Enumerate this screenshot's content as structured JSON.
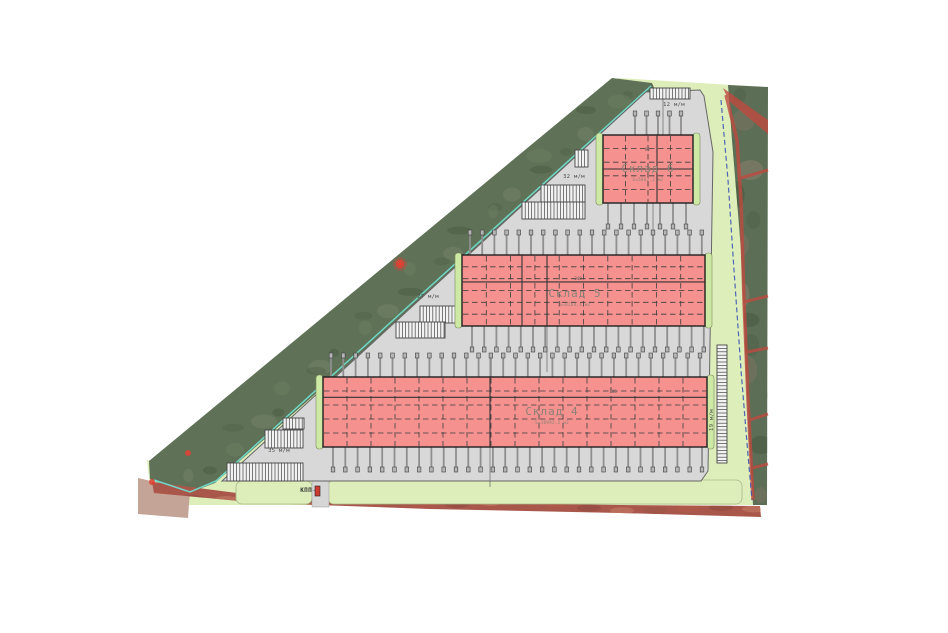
{
  "plan": {
    "buildings": [
      {
        "id": "sklad-6",
        "label": "Склад 6",
        "area": "S=5867,2 м2",
        "dim": "96"
      },
      {
        "id": "sklad-5",
        "label": "Склад 5",
        "area": "S=8264,4 м2",
        "dim": "240"
      },
      {
        "id": "sklad-4",
        "label": "Склад 4",
        "area": "S=10992,2 м2",
        "dim": "106"
      }
    ],
    "parking_labels": [
      {
        "id": "north-tip",
        "label": "12 м/м"
      },
      {
        "id": "upper",
        "label": "32 м/м"
      },
      {
        "id": "middle",
        "label": "27 м/м"
      },
      {
        "id": "lower",
        "label": "35 м/м"
      },
      {
        "id": "east-side",
        "label": "19 м/м"
      }
    ],
    "checkpoint_label": "КПП",
    "colors": {
      "building_fill": "#f5928f",
      "greenery": "#ddeebb",
      "satellite_green": "#5f7257",
      "paved": "#d8d8d8",
      "boundary_red": "#bf4a40",
      "cadastral_blue": "#3f55b5",
      "teal_edge": "#6fd8c8"
    }
  }
}
